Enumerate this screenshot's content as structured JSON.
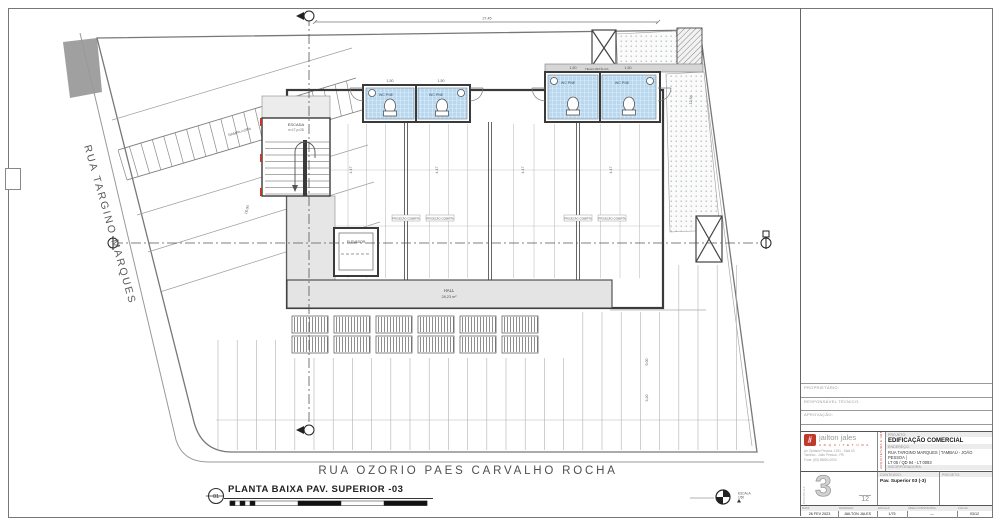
{
  "colors": {
    "accent_red": "#c0392b",
    "tile_blue": "#b9d7ee",
    "wall_dark": "#3a3a3a"
  },
  "plan": {
    "street_left": "RUA TARGINO MARQUES",
    "street_bottom": "RUA OZORIO PAES CARVALHO ROCHA",
    "hall_name": "HALL",
    "hall_area": "28,23 m²",
    "elevator_label": "ELEVADOR",
    "stair_label": "ESCADA",
    "stair_note": "e=17 p=28",
    "wc_label": "WC PNE",
    "roof_strip_label": "TELHA METÁLICA",
    "projection_label": "PROJEÇÃO COBERTA",
    "north_scale_line1": "ESCALA",
    "north_scale_line2": "1/50",
    "dims": [
      {
        "x": 487,
        "y": 19.5,
        "r": 0,
        "t": "27,45"
      },
      {
        "x": 352,
        "y": 170,
        "r": -90,
        "t": "4,47"
      },
      {
        "x": 438,
        "y": 170,
        "r": -90,
        "t": "4,47"
      },
      {
        "x": 524,
        "y": 170,
        "r": -90,
        "t": "4,47"
      },
      {
        "x": 612,
        "y": 170,
        "r": -90,
        "t": "4,47"
      },
      {
        "x": 248,
        "y": 210,
        "r": -76,
        "t": "16,00"
      },
      {
        "x": 692,
        "y": 100,
        "r": -85,
        "t": "12,50"
      },
      {
        "x": 240,
        "y": 133,
        "r": -17,
        "t": "RAMPA i=20%"
      },
      {
        "x": 390,
        "y": 82,
        "r": 0,
        "t": "1,50"
      },
      {
        "x": 441,
        "y": 82,
        "r": 0,
        "t": "1,50"
      },
      {
        "x": 573,
        "y": 69,
        "r": 0,
        "t": "1,50"
      },
      {
        "x": 628,
        "y": 69,
        "r": 0,
        "t": "1,50"
      },
      {
        "x": 648,
        "y": 362,
        "r": -90,
        "t": "5,00"
      },
      {
        "x": 648,
        "y": 398,
        "r": -90,
        "t": "3,20"
      }
    ]
  },
  "footer": {
    "detail_number": "01",
    "title": "PLANTA BAIXA PAV. SUPERIOR -03"
  },
  "titleblock": {
    "pre_rows": [
      "PROPRIETÁRIO:",
      "RESPONSÁVEL TÉCNICO:",
      "APROVAÇÃO:"
    ],
    "logo_mark": "jj",
    "logo_name": "jailton jales",
    "logo_sub": "A R Q U I T E T U R A",
    "logo_lines": [
      "Av. Epitácio Pessoa, 1251 - Sala 03",
      "Tambaú - João Pessoa - PB",
      "Fone: (83) 98800-0000"
    ],
    "side_note": "ARQUITETURA E URBANISMO",
    "projeto_label": "PROJETO:",
    "projeto": "EDIFICAÇÃO COMERCIAL",
    "endereco_label": "ENDEREÇO:",
    "endereco1": "RUA TARGINO MARQUES | TAMBAÚ - JOÃO PESSOA |",
    "endereco2": "LT 05 / QD 94 - LT 0093",
    "incorp_label": "INCORPORADORA:",
    "incorp": "DBA CONSTRUÇÕES E INCORPORAÇÕES LTDA",
    "prancha_side": "PRANCHA",
    "sheet_number": "3",
    "sheet_total": "12",
    "conteudo_label": "CONTEÚDO:",
    "conteudo": "Pav. Superior 03 (-3)",
    "projeto2_label": "PROJETO:",
    "data_label": "DATA:",
    "data_value": "26 FEV 2023",
    "desenho_label": "DESENHO:",
    "desenho_value": "JAILTON JALES",
    "escala_label": "ESCALA:",
    "escala_value": "1/75",
    "area_label": "ÁREA CONSTRUÍDA:",
    "area_value": "—",
    "folha_label": "FOLHA:",
    "folha_value": "03/12"
  }
}
